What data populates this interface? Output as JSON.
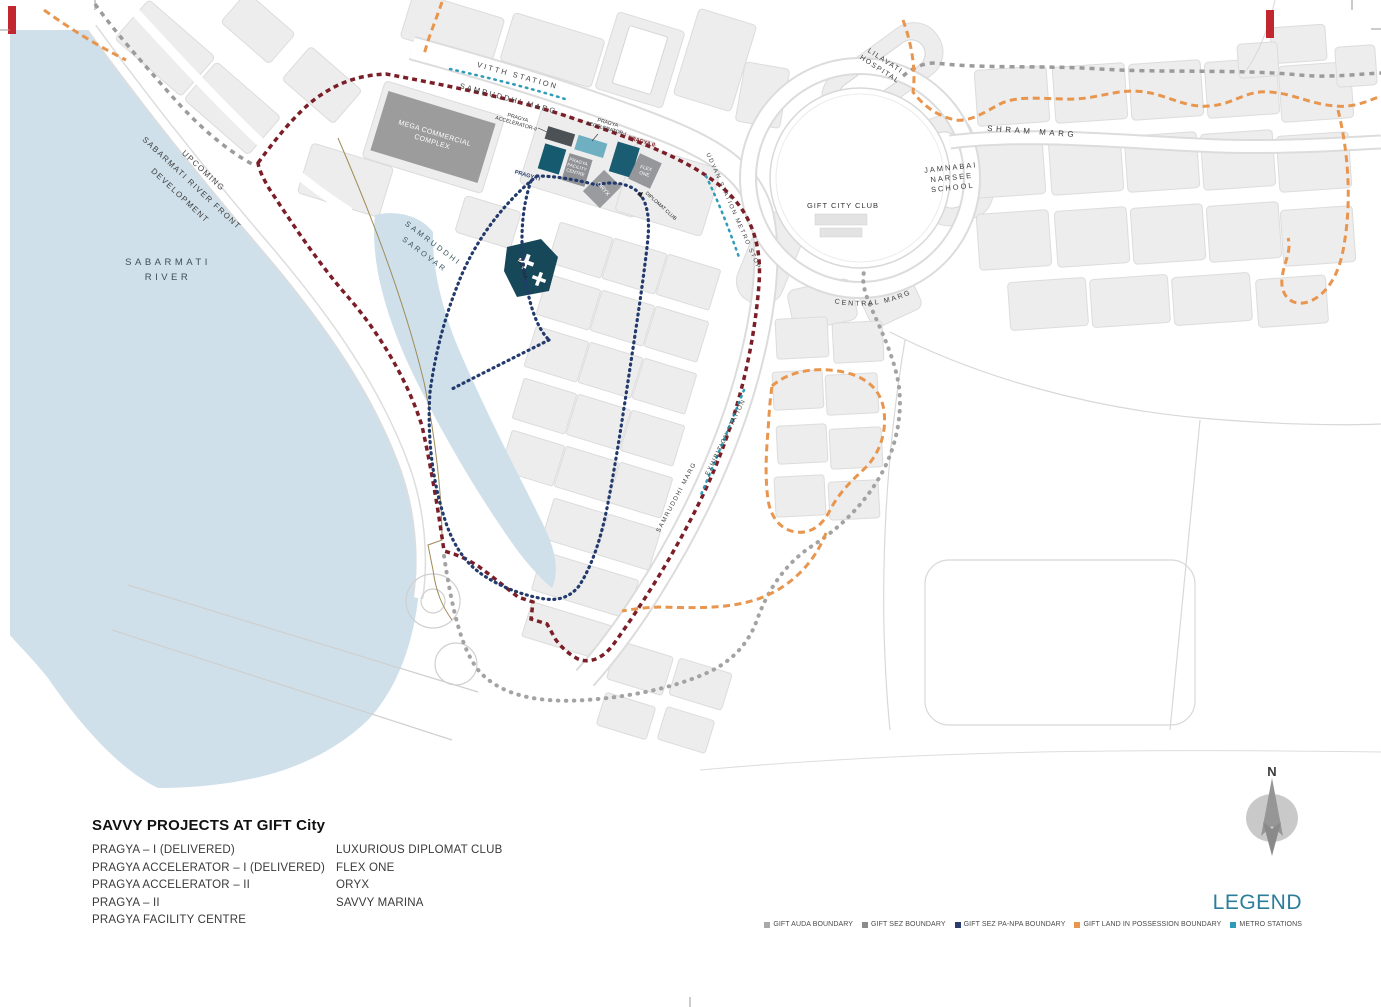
{
  "map": {
    "labels": {
      "vitth_station": "VITTH STATION",
      "samruddhi_marg_top": "SAMRUDDHI MARG",
      "upcoming_line1": "UPCOMING",
      "upcoming_line2": "SABARMATI RIVER FRONT",
      "upcoming_line3": "DEVELOPMENT",
      "sabarmati_line1": "SABARMATI",
      "sabarmati_line2": "RIVER",
      "sarovar_line1": "SAMRUDDHI",
      "sarovar_line2": "SAROVAR",
      "marina": "MARINA",
      "mega_line1": "MEGA COMMERCIAL",
      "mega_line2": "COMPLEX",
      "pragya_accel2_line1": "PRAGYA",
      "pragya_accel2_line2": "ACCELERATOR-II",
      "pragya_accel1_line1": "PRAGYA",
      "pragya_accel1_line2": "ACCELERATOR-I",
      "pragya_ii": "PRAGYA II",
      "pragya_i": "PRAGYA I",
      "facility_line1": "PRAGYA",
      "facility_line2": "FACILITY",
      "facility_line3": "CENTRE",
      "oryx": "ORYX",
      "flex_line1": "FLEX",
      "flex_line2": "ONE",
      "diplomat_club": "DIPLOMAT CLUB",
      "udyan_station": "UDYAN STATION METRO STOP",
      "gift_city_club": "GIFT CITY CLUB",
      "central_marg": "CENTRAL MARG",
      "jamnabai_line1": "JAMNABAI",
      "jamnabai_line2": "NARSEE",
      "jamnabai_line3": "SCHOOL",
      "lilavati_line1": "LILAVATI",
      "lilavati_line2": "HOSPITAL",
      "shram_marg": "SHRAM MARG",
      "samruddhi_marg_mid": "SAMRUDDHI MARG",
      "exhibition_station": "EXHIBITION STATION"
    },
    "colors": {
      "river": "#cfe0ea",
      "auda_boundary_line": "#9b9b9b",
      "sez_boundary_line": "#7b1e28",
      "pa_npa_boundary_line": "#233a6c",
      "possession_boundary_line": "#e8954e",
      "metro_line": "#2e9cb8",
      "savvy_building_dark_teal": "#16586b",
      "delivered_building_teal": "#6fafc2",
      "other_building_gray": "#949494"
    }
  },
  "projects": {
    "title": "SAVVY PROJECTS AT GIFT City",
    "column1": [
      "PRAGYA – I (DELIVERED)",
      "PRAGYA ACCELERATOR – I (DELIVERED)",
      "PRAGYA ACCELERATOR – II",
      "PRAGYA – II",
      "PRAGYA FACILITY CENTRE"
    ],
    "column2": [
      "LUXURIOUS DIPLOMAT CLUB",
      "FLEX ONE",
      "ORYX",
      "SAVVY MARINA"
    ]
  },
  "legend": {
    "title": "LEGEND",
    "items": [
      {
        "label": "GIFT AUDA BOUNDARY",
        "color": "#a9a9a9"
      },
      {
        "label": "GIFT SEZ BOUNDARY",
        "color": "#8c8c8c"
      },
      {
        "label": "GIFT SEZ PA-NPA BOUNDARY",
        "color": "#2a3b6e"
      },
      {
        "label": "GIFT LAND IN POSSESSION  BOUNDARY",
        "color": "#e8954e"
      },
      {
        "label": "METRO STATIONS",
        "color": "#2e9cb8"
      }
    ]
  },
  "compass": {
    "north": "N"
  }
}
